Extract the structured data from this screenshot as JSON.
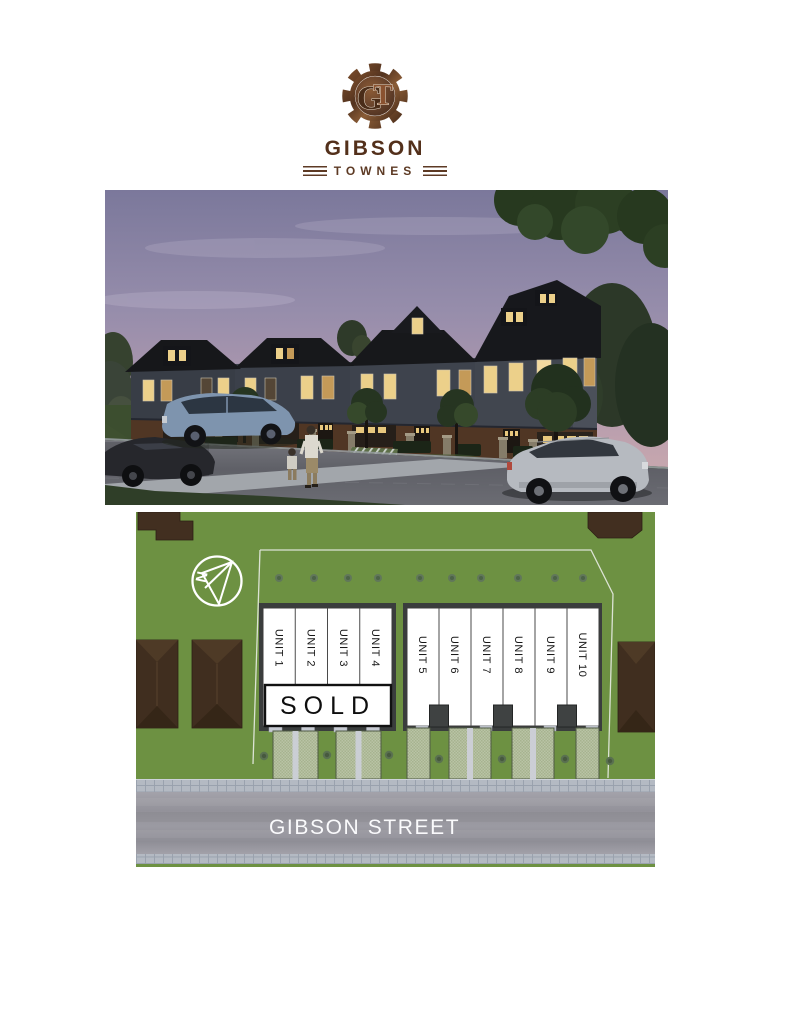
{
  "logo": {
    "monogram": {
      "g": "G",
      "t": "T"
    },
    "name": "GIBSON",
    "subname": "TOWNES",
    "rust_color": "#7a4a2a",
    "text_color": "#53301b"
  },
  "hero": {
    "colors": {
      "sky_top": "#7b789b",
      "sky_horizon": "#cbadb2",
      "roof": "#17181b",
      "siding": "#3e434d",
      "brick": "#503624",
      "window_glow": "#ecd08a",
      "lawn": "#3e5030",
      "road": "#5f6067"
    }
  },
  "site_plan": {
    "compass_label": "N",
    "units": [
      "UNIT 1",
      "UNIT 2",
      "UNIT 3",
      "UNIT 4",
      "UNIT 5",
      "UNIT 6",
      "UNIT 7",
      "UNIT 8",
      "UNIT 9",
      "UNIT 10"
    ],
    "sold_banner": {
      "label": "SOLD",
      "covers_units": [
        "UNIT 1",
        "UNIT 2",
        "UNIT 3",
        "UNIT 4"
      ]
    },
    "street_label": "GIBSON STREET",
    "colors": {
      "grass": "#6d9142",
      "road": "#97969e",
      "sidewalk": "#b4bac3",
      "neighbor_roof": "#422f20",
      "unit_fill": "#ffffff",
      "driveway": "#b9c3a6",
      "block_outline": "#3a3d3d"
    }
  }
}
